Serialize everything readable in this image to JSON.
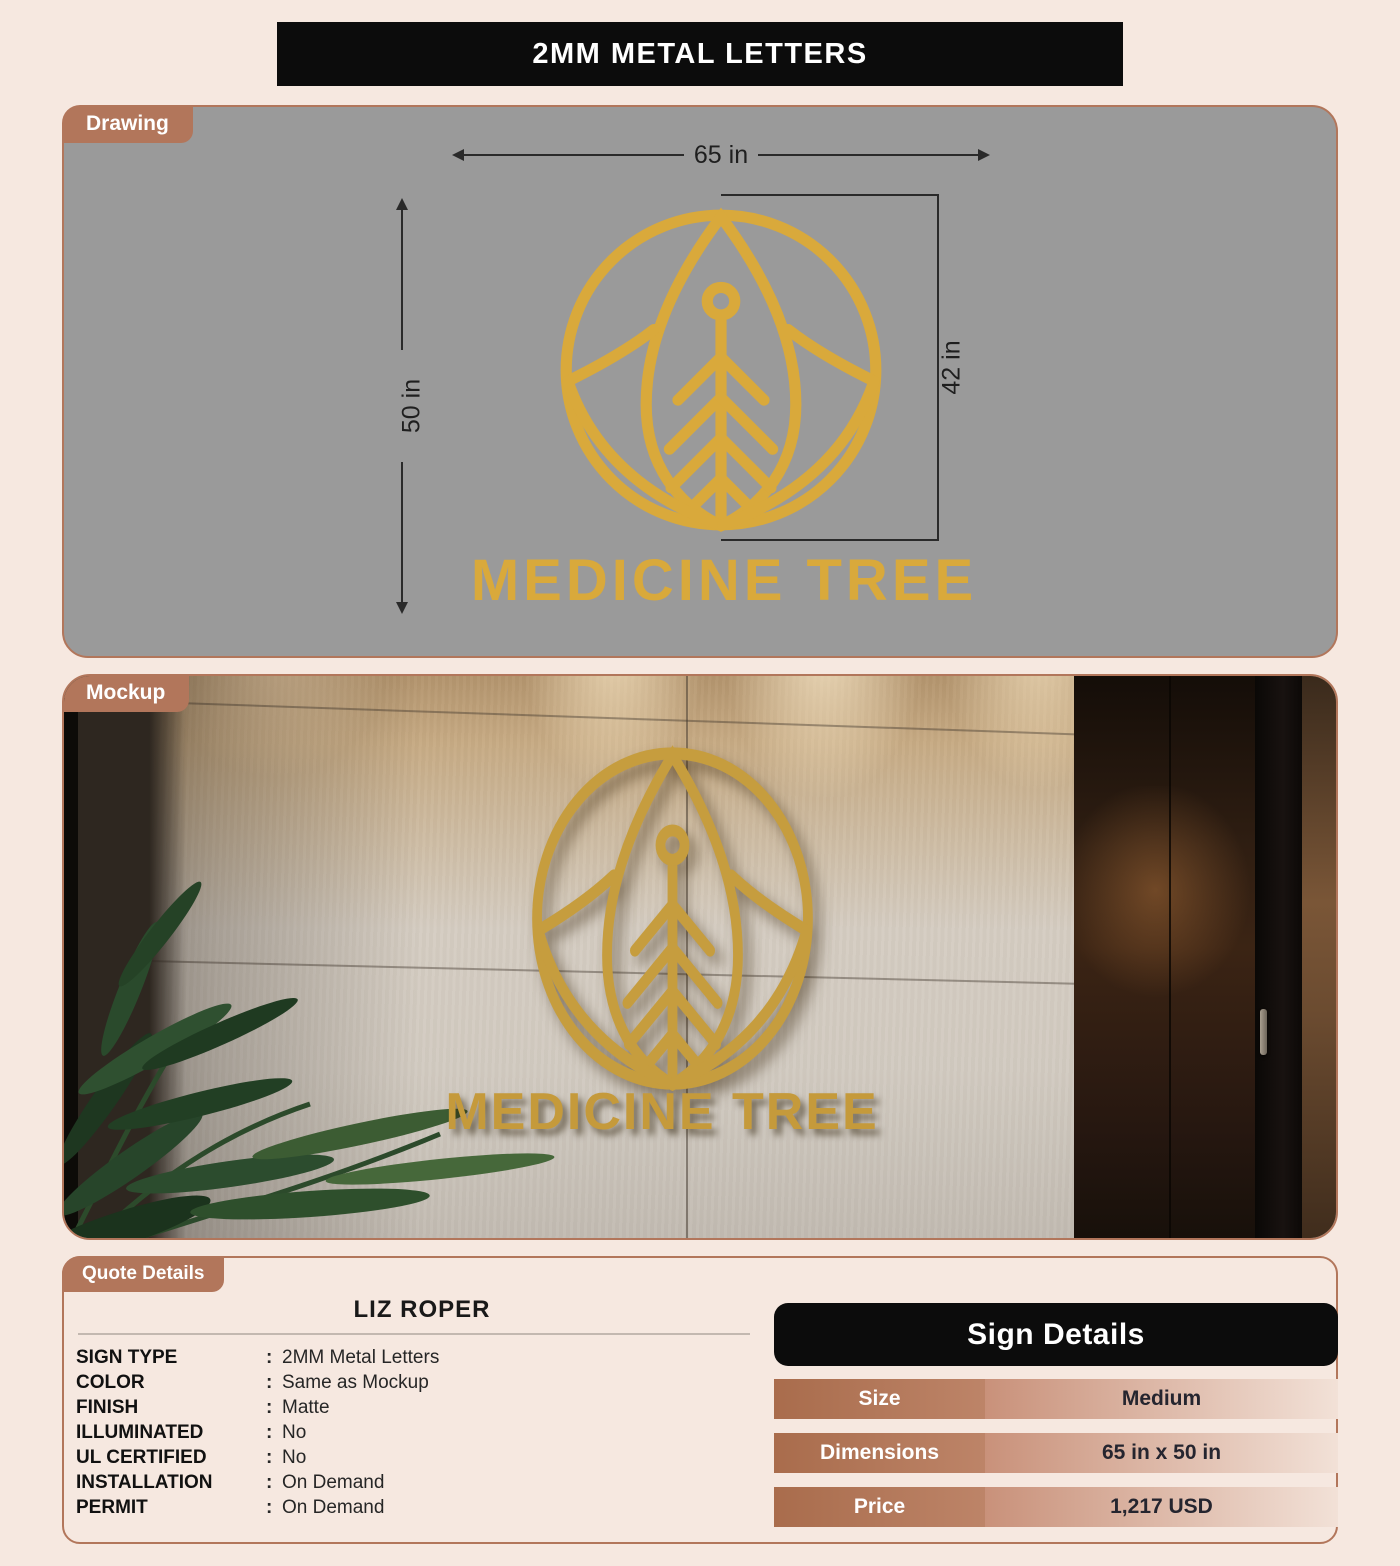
{
  "page": {
    "title": "2MM METAL LETTERS"
  },
  "drawing": {
    "tab": "Drawing",
    "width_label": "65 in",
    "height_label": "50 in",
    "logo_height_label": "42 in",
    "logo_text": "MEDICINE TREE"
  },
  "mockup": {
    "tab": "Mockup",
    "logo_text": "MEDICINE TREE"
  },
  "quote": {
    "tab": "Quote Details",
    "customer": "LIZ ROPER",
    "colon": ":",
    "specs": [
      {
        "label": "SIGN TYPE",
        "value": "2MM Metal Letters"
      },
      {
        "label": "COLOR",
        "value": "Same as Mockup"
      },
      {
        "label": "FINISH",
        "value": "Matte"
      },
      {
        "label": "ILLUMINATED",
        "value": "No"
      },
      {
        "label": "UL CERTIFIED",
        "value": "No"
      },
      {
        "label": "INSTALLATION",
        "value": "On Demand"
      },
      {
        "label": "PERMIT",
        "value": "On Demand"
      }
    ]
  },
  "sign_details": {
    "title": "Sign Details",
    "rows": [
      {
        "label": "Size",
        "value": "Medium"
      },
      {
        "label": "Dimensions",
        "value": "65 in x 50 in"
      },
      {
        "label": "Price",
        "value": "1,217 USD"
      }
    ]
  },
  "colors": {
    "page_background": "#f6e8e0",
    "accent_terracotta": "#b2765b",
    "banner_black": "#0c0c0c",
    "drawing_background": "#9a9a9a",
    "logo_gold_drawing": "#d9a93b",
    "logo_gold_mockup": "#c69d3e"
  }
}
